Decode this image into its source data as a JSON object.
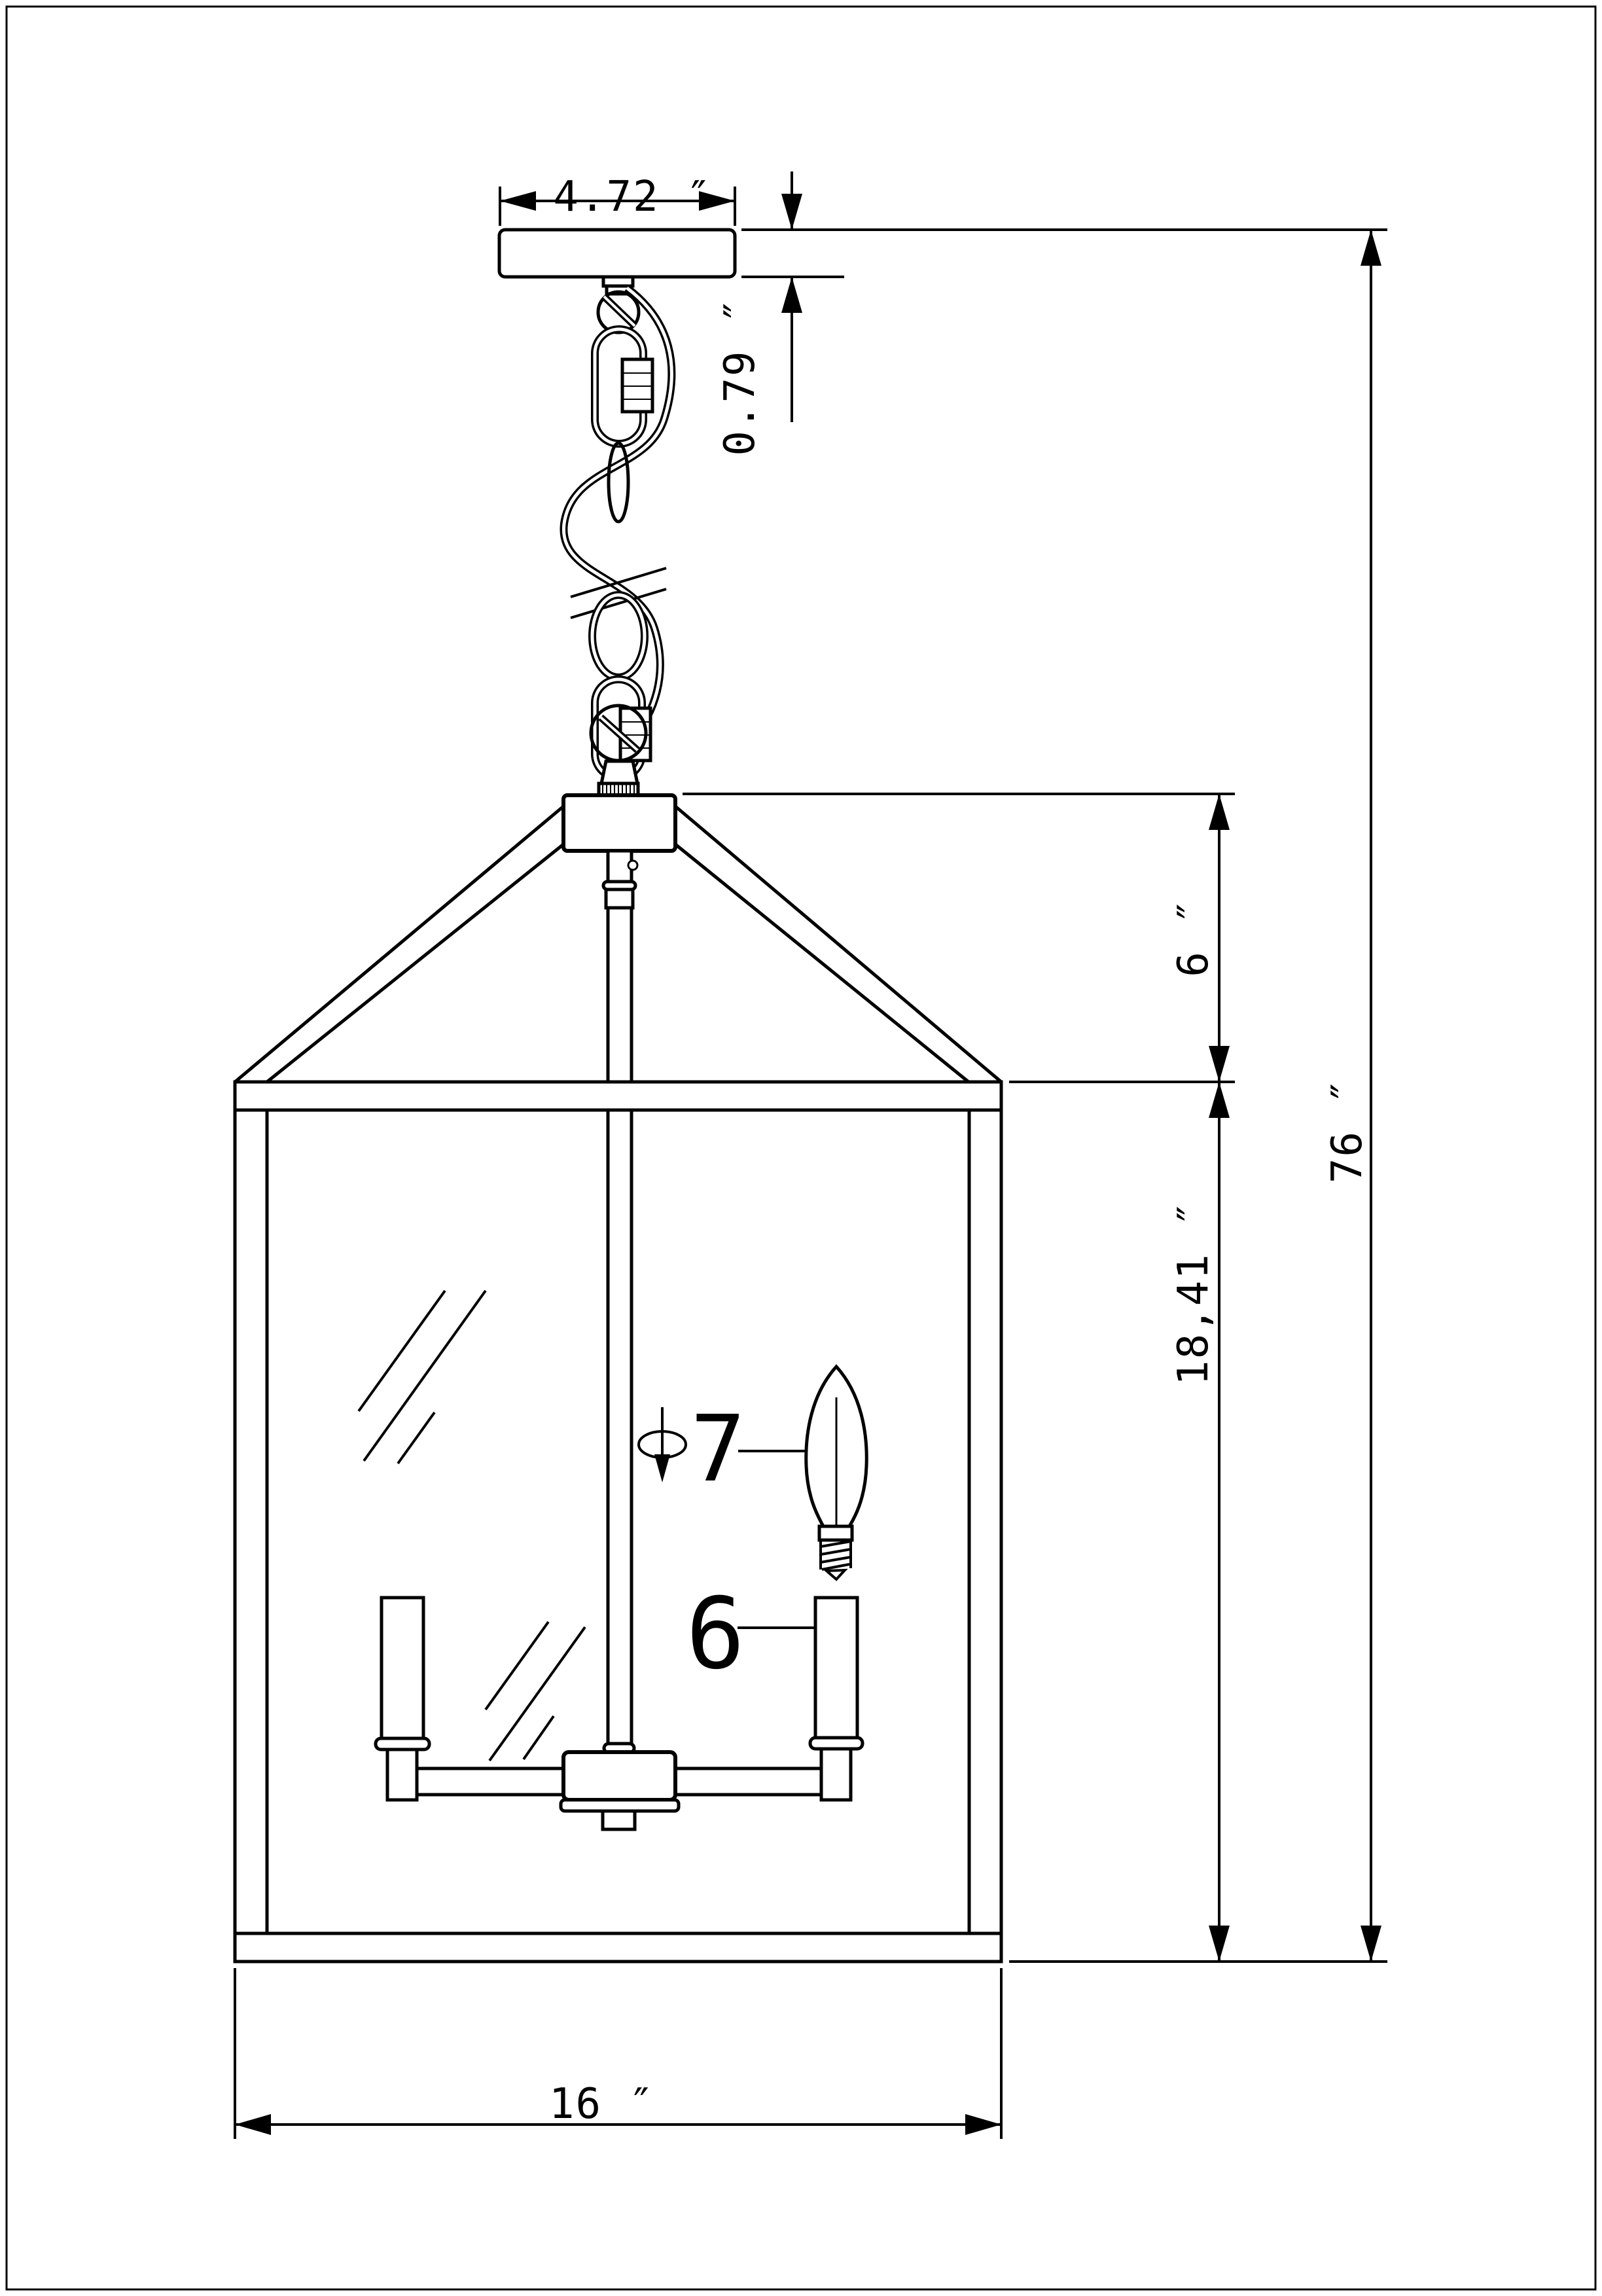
{
  "drawing": {
    "kind": "technical dimension drawing",
    "subject": "lantern pendant light fixture, front elevation",
    "background": "#ffffff",
    "line_color": "#000000"
  },
  "dimensions": {
    "canopy_width": "4.72 ″",
    "canopy_height": "0.79 ″",
    "roof_height": "6 ″",
    "overall_height": "76 ″",
    "body_height": "18,41 ″",
    "body_width": "16 ″"
  },
  "callouts": {
    "bulb_label": "7",
    "socket_label": "6",
    "diameter_symbol": "phi-arrow-icon"
  }
}
